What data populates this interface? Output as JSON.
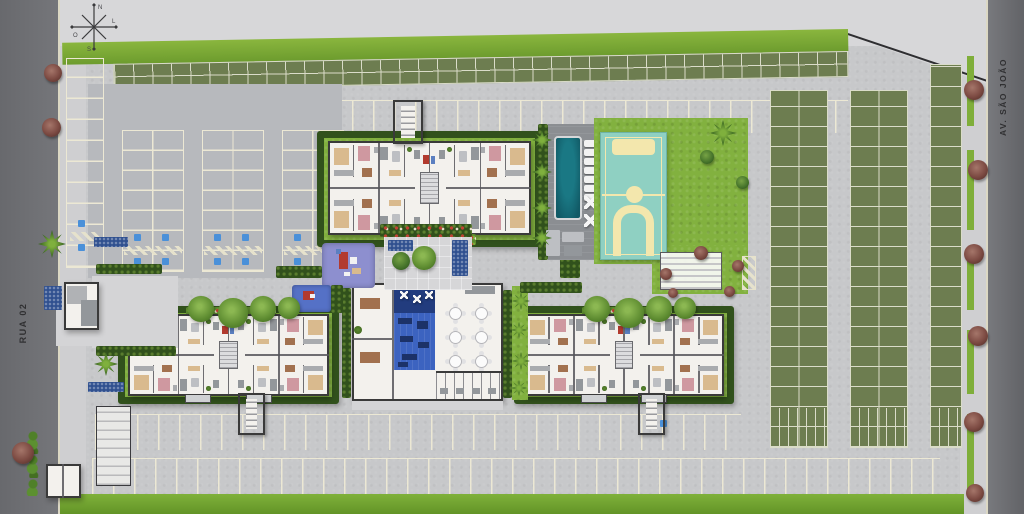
{
  "streets": {
    "left": "RUA 02",
    "right": "AV. SÃO JOÃO"
  },
  "compass": {
    "north": "N",
    "east": "L",
    "south": "S",
    "west": "O"
  },
  "palette": {
    "outside": "#d7d7d9",
    "concrete": "#c7c8ca",
    "sidewalk": "#cfcfd1",
    "road": "#6e6f73",
    "asphalt": "#b7b9bd",
    "stall_line": "#ece8d4",
    "grass": "#79a836",
    "lawn": "#82b13f",
    "hedge": "#31511c",
    "paver": "#6d7d50",
    "paver_line": "#dadcc9",
    "building_floor": "#f3f1ed",
    "wall": "#3a3a3a",
    "pool": "#13606c",
    "deck": "#8b8e92",
    "court": "#8fd0c2",
    "court_line": "#f3e7ad",
    "playground": "#8d8fcf",
    "play_mat": "#5571c6",
    "club_blue": "#3c63c0",
    "club_navy": "#223c7e",
    "flower_bed": "#30508f",
    "accessible_stall": "#4a90d9",
    "tree_red": "#7c4a42",
    "tree_green": "#3f6a22",
    "accent_red": "#b23a2e"
  }
}
